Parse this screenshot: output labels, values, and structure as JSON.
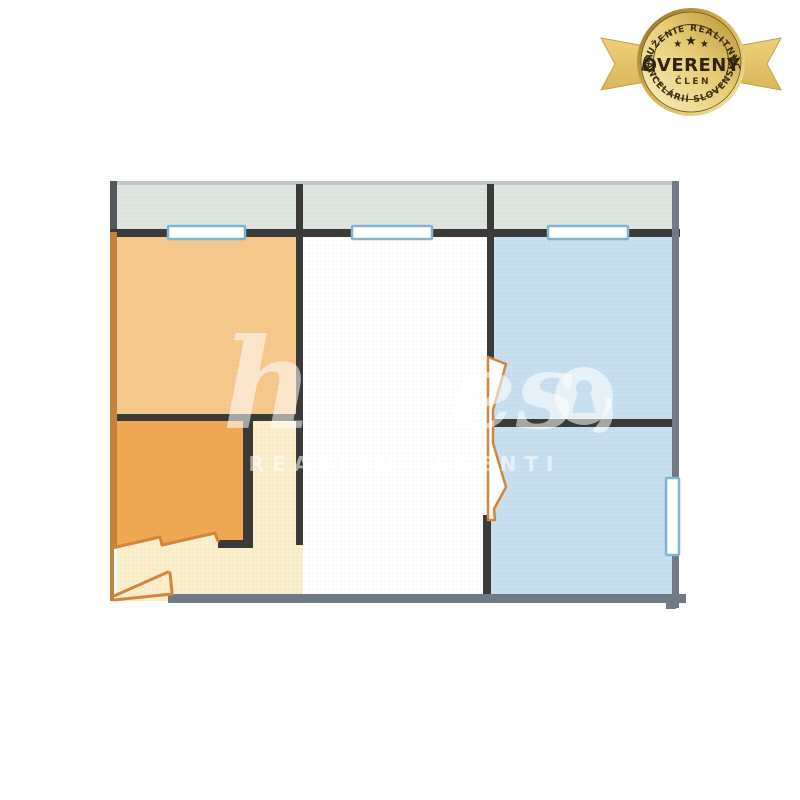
{
  "badge": {
    "arc_top": "ZDRUŽENIE REALITNÝCH",
    "title": "OVERENÝ",
    "subtitle": "ČLEN",
    "arc_bottom": "KANCELÁRIÍ SLOVENSKA",
    "stars": [
      "★",
      "★",
      "★"
    ]
  },
  "watermark": {
    "script_left": "h",
    "script_right": "es",
    "keyhole_icon": "keyhole",
    "subtitle": "REALITNÍ AGENTI"
  },
  "colors": {
    "balcony": "#dee4e0",
    "balcony_edge": "#c3cac5",
    "room_peach": "#f6c88c",
    "room_orange": "#f0a952",
    "hallway": "#faeecc",
    "room_white": "#ffffff",
    "room_blue": "#c8dff0",
    "wall_dark": "#3a3b38",
    "wall_gray": "#6f7a86",
    "wall_orange": "#c4823c",
    "door_orange": "#d2863b",
    "window_border": "#7fb6d6",
    "watermark": "rgba(255,255,255,0.55)",
    "badge_text": "#3a2d11",
    "gold_dark": "#8e6c20",
    "gold_mid": "#d4b04e",
    "gold_light": "#f6e9ae",
    "ribbon_gold": "#ecd07a"
  }
}
